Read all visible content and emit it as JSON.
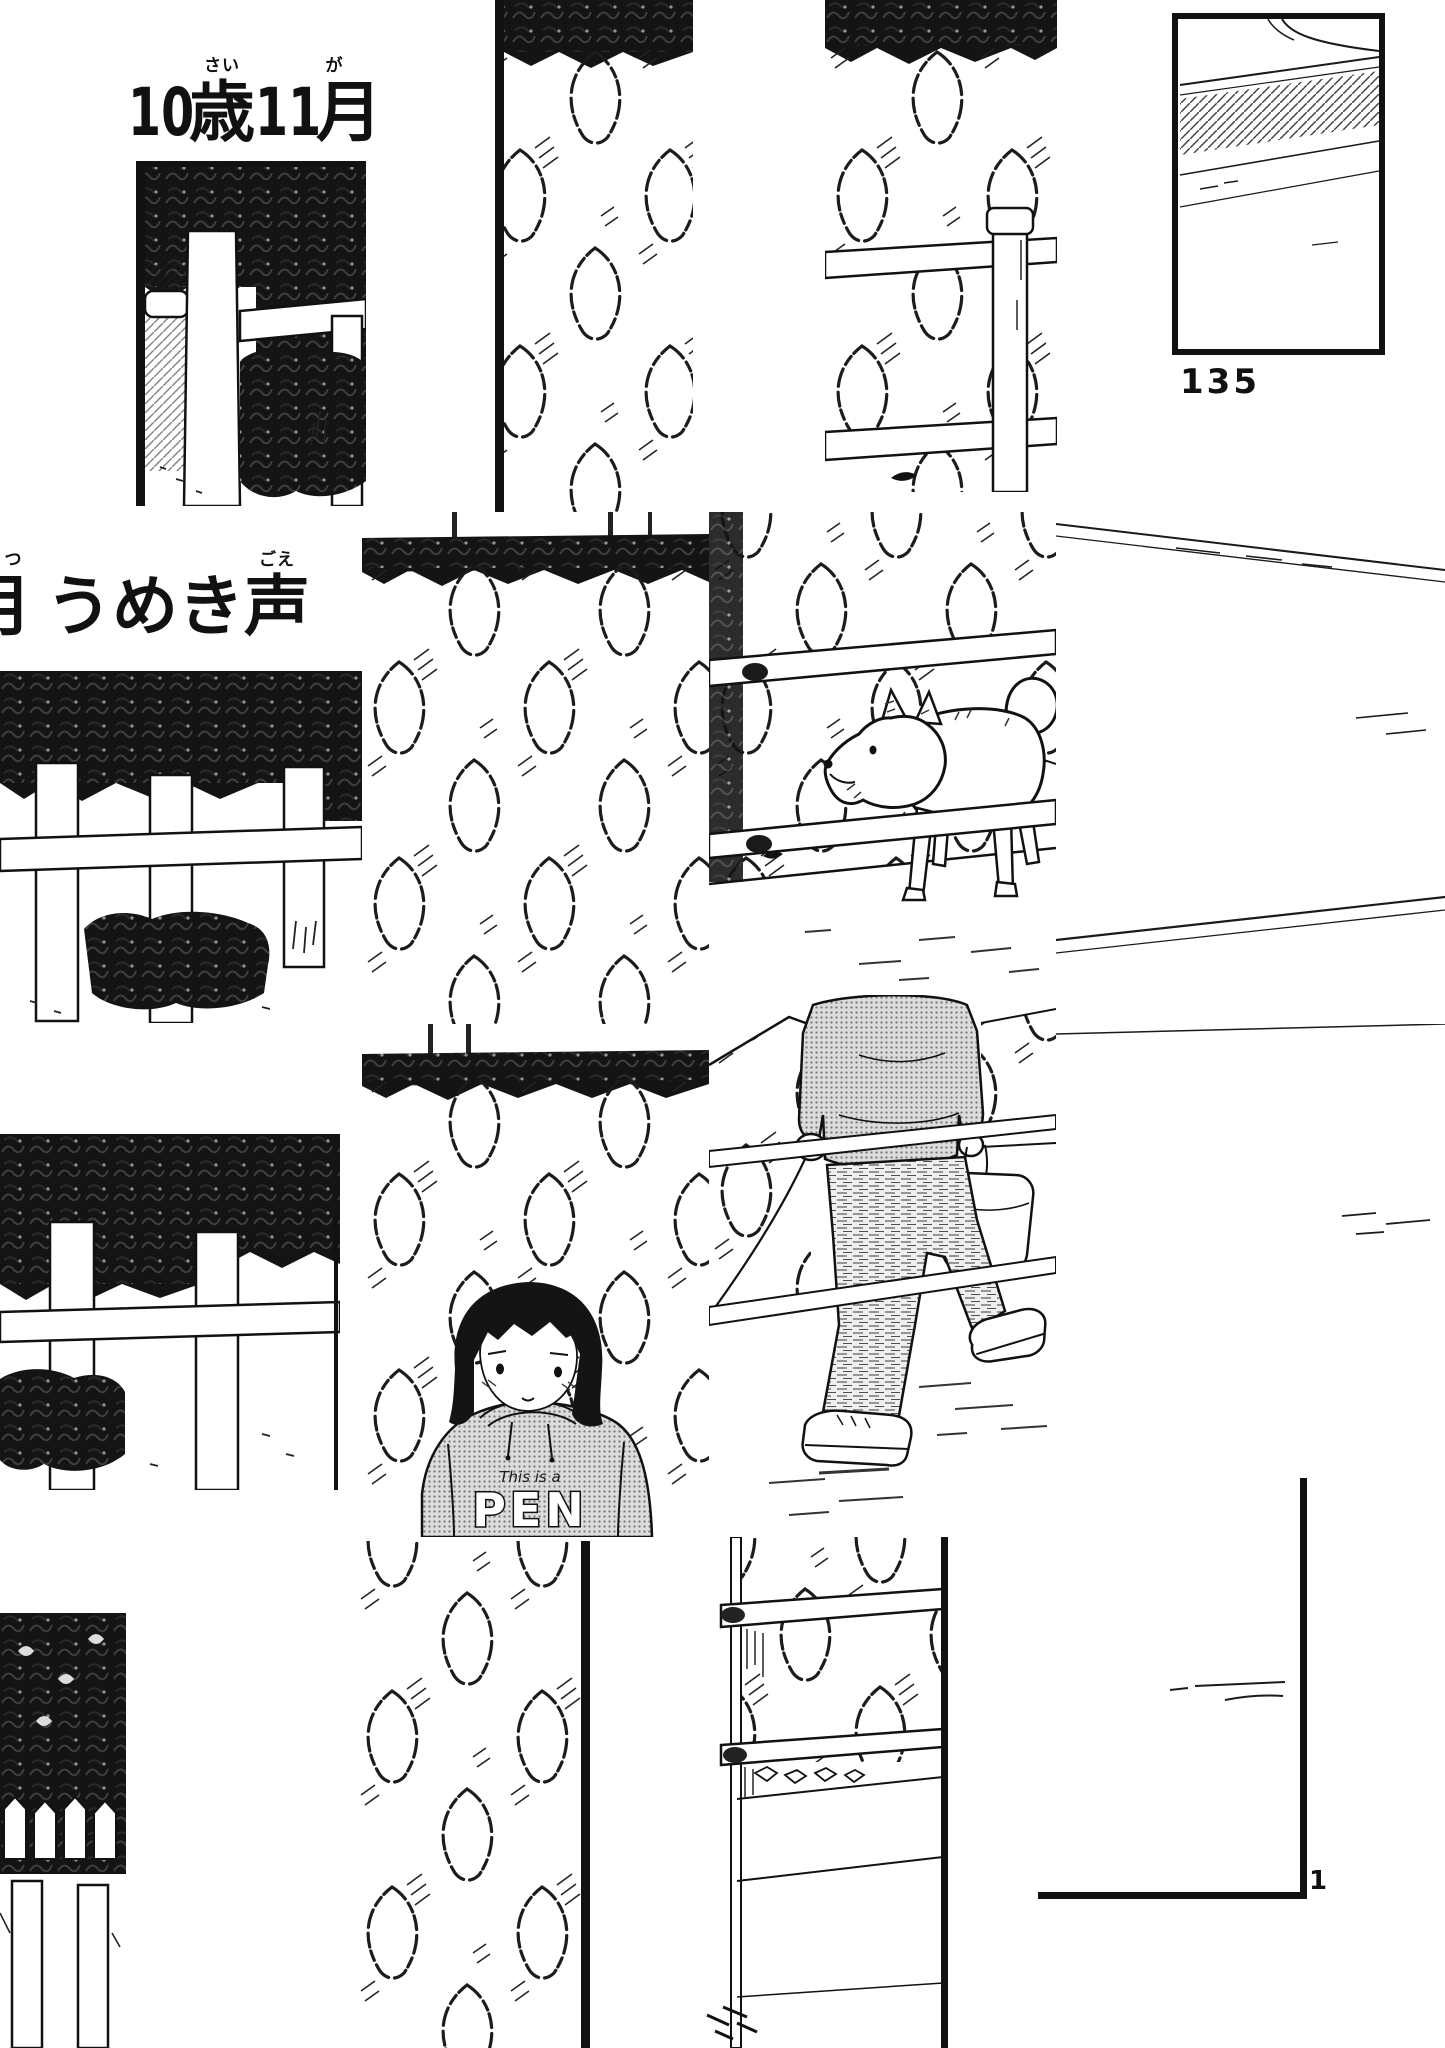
{
  "page": {
    "paper_color": "#ffffff",
    "ink_color": "#1a1a1a",
    "halftone_gray": "#c9c9c9"
  },
  "captions": {
    "age": {
      "num_age": "10",
      "kanji_age": "歳",
      "furi_age": "さい",
      "num_month": "11",
      "kanji_month": "月",
      "furi_month": "が"
    },
    "groan": {
      "partial_kanji": "月",
      "partial_furi": "つ",
      "word_head": "うめき",
      "kanji_voice": "声",
      "furi_voice": "ごえ"
    }
  },
  "page_numbers": {
    "left": "135",
    "right": "1"
  },
  "hoodie_print": {
    "line1": "This is a",
    "line2": "PEN"
  }
}
